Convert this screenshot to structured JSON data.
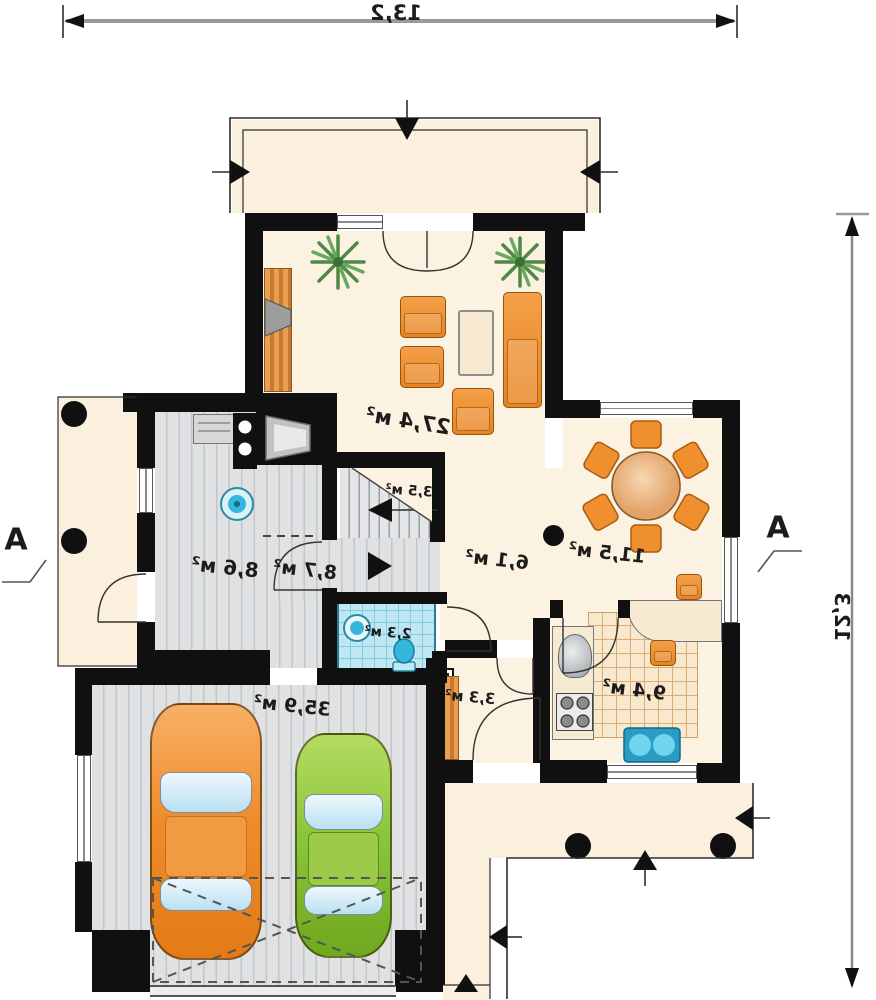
{
  "plan": {
    "dimensions": {
      "top": "13,2",
      "right": "12,3"
    },
    "section_markers": {
      "left": "A",
      "right": "A"
    },
    "rooms": {
      "living": {
        "area": "27,4 м²"
      },
      "utility": {
        "area": "8,6 м²"
      },
      "hallway": {
        "area": "8,7 м²"
      },
      "stairs": {
        "area": "3,5 м²"
      },
      "hall": {
        "area": "6,1 м²"
      },
      "dining": {
        "area": "11,5 м²"
      },
      "bathroom": {
        "area": "2,3 м²"
      },
      "entry": {
        "area": "3,3 м²"
      },
      "kitchen": {
        "area": "9,4 м²"
      },
      "garage": {
        "area": "35,9 м²"
      }
    },
    "colors": {
      "wall": "#101010",
      "floor_cream": "#fcf2e1",
      "floor_gray": "#dfe1e3",
      "tile_blue": "#bfe7f1",
      "tile_kitchen": "#f8e8cd",
      "furniture_orange": "#ef8f2e",
      "car_orange": "#ee8c2c",
      "car_green": "#8cc63e",
      "fixture_blue": "#35b6dd",
      "plant_green": "#4e8a46"
    }
  }
}
